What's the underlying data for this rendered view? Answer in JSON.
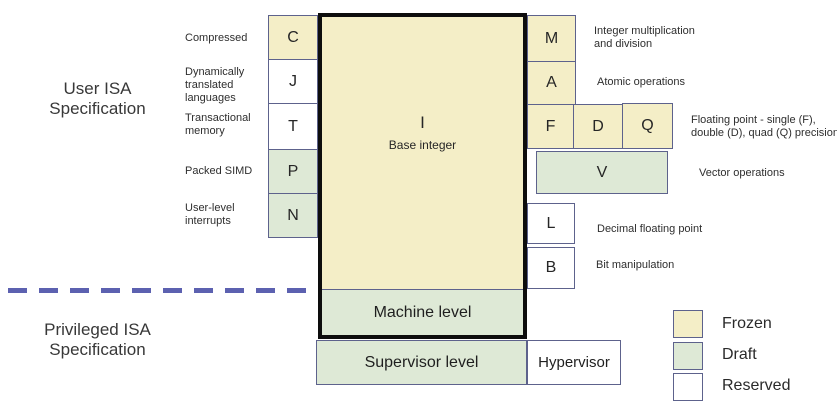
{
  "colors": {
    "frozen": "#f4eec7",
    "draft": "#dee9d6",
    "reserved": "#ffffff",
    "border": "#5d628c",
    "dash": "#5c61b0",
    "thick": "#0d0d0d",
    "text": "#2e2e2e"
  },
  "titles": {
    "user": "User ISA\nSpecification",
    "privileged": "Privileged ISA\nSpecification"
  },
  "base": {
    "letter": "I",
    "label": "Base integer"
  },
  "levels": {
    "machine": {
      "label": "Machine level",
      "status": "draft"
    },
    "supervisor": {
      "label": "Supervisor level",
      "status": "draft"
    },
    "hypervisor": {
      "label": "Hypervisor",
      "status": "reserved"
    }
  },
  "boxes": {
    "c": {
      "letter": "C",
      "status": "frozen"
    },
    "j": {
      "letter": "J",
      "status": "reserved"
    },
    "t": {
      "letter": "T",
      "status": "reserved"
    },
    "p": {
      "letter": "P",
      "status": "draft"
    },
    "n": {
      "letter": "N",
      "status": "draft"
    },
    "m": {
      "letter": "M",
      "status": "frozen"
    },
    "a": {
      "letter": "A",
      "status": "frozen"
    },
    "f": {
      "letter": "F",
      "status": "frozen"
    },
    "d": {
      "letter": "D",
      "status": "frozen"
    },
    "q": {
      "letter": "Q",
      "status": "frozen"
    },
    "v": {
      "letter": "V",
      "status": "draft"
    },
    "l": {
      "letter": "L",
      "status": "reserved"
    },
    "b": {
      "letter": "B",
      "status": "reserved"
    }
  },
  "labels": {
    "c": "Compressed",
    "j": "Dynamically\ntranslated\nlanguages",
    "t": "Transactional\nmemory",
    "p": "Packed SIMD",
    "n": "User-level\ninterrupts",
    "m": "Integer multiplication\nand division",
    "a": "Atomic operations",
    "fdq": "Floating point - single (F),\ndouble (D), quad (Q) precision",
    "v": "Vector operations",
    "l": "Decimal floating point",
    "b": "Bit manipulation"
  },
  "legend": [
    {
      "label": "Frozen",
      "status": "frozen"
    },
    {
      "label": "Draft",
      "status": "draft"
    },
    {
      "label": "Reserved",
      "status": "reserved"
    }
  ]
}
